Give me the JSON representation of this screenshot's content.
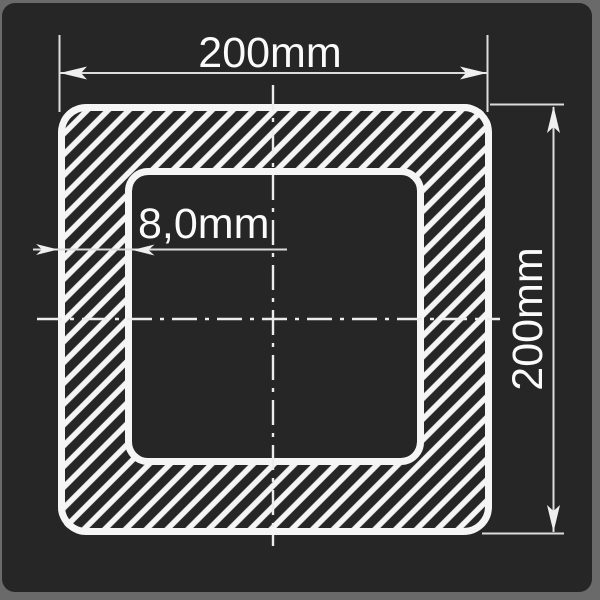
{
  "drawing": {
    "outer_width_label": "200mm",
    "outer_height_label": "200mm",
    "wall_thickness_label": "8,0mm"
  },
  "colors": {
    "frame": "#6a6a6a",
    "panel": "#262626",
    "line_bright": "#f5f5f5",
    "line_thin": "#dcdcdc"
  }
}
